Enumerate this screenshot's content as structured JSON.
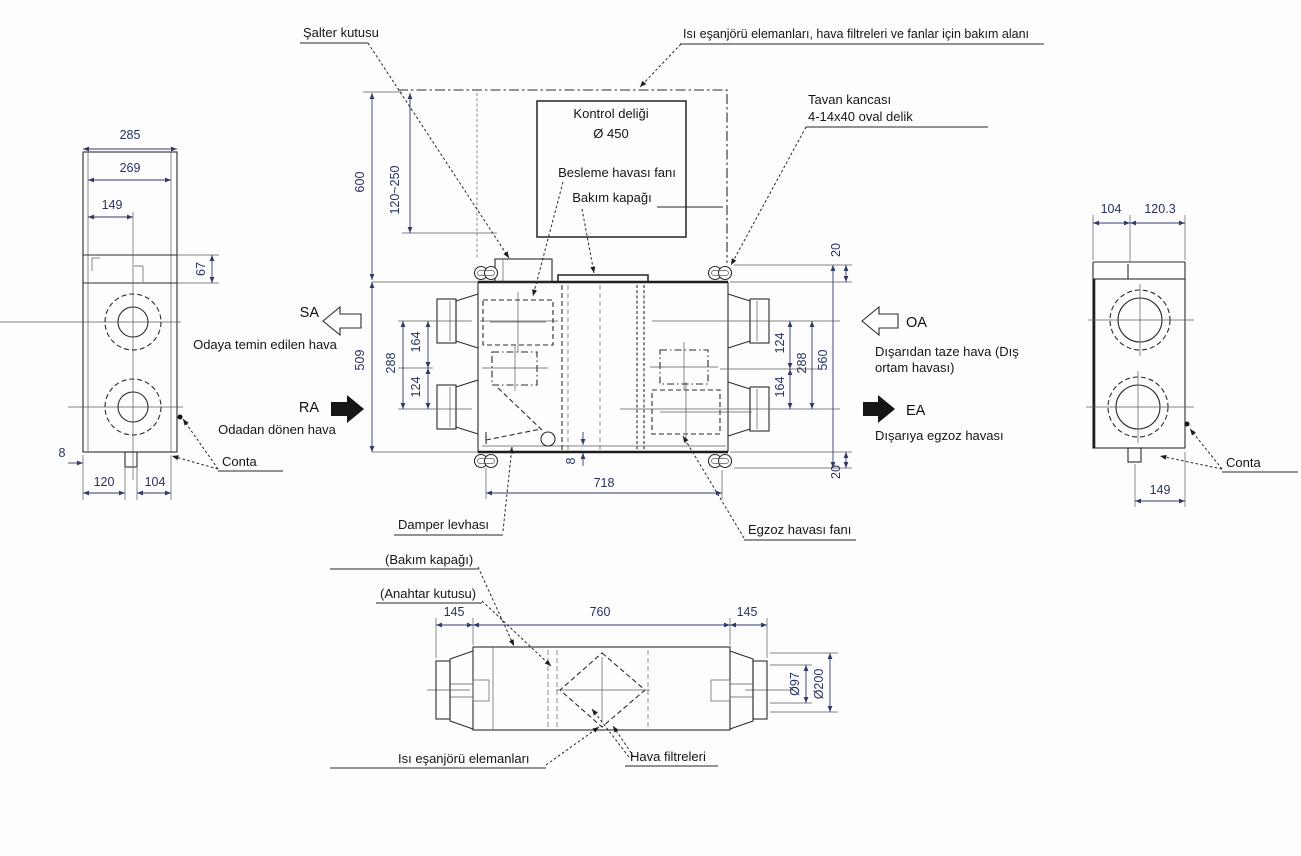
{
  "meta": {
    "drawing_type": "Isı geri kazanım cihazı boyut çizimi"
  },
  "top_labels": {
    "salter_kutusu": "Şalter kutusu",
    "bakim_alani": "Isı eşanjörü elemanları, hava filtreleri ve fanlar için bakım alanı",
    "kontrol_deligi": "Kontrol deliği",
    "kontrol_deligi_cap": "Ø 450",
    "besleme_fani": "Besleme havası fanı",
    "bakim_kapagi": "Bakım kapağı",
    "tavan_kancasi": "Tavan kancası",
    "tavan_kancasi_detay": "4-14x40 oval delik"
  },
  "plan_labels": {
    "damper_levhasi": "Damper levhası",
    "egzoz_fani": "Egzoz havası fanı"
  },
  "airflow": {
    "sa_code": "SA",
    "sa_desc": "Odaya temin edilen hava",
    "ra_code": "RA",
    "ra_desc": "Odadan dönen hava",
    "oa_code": "OA",
    "oa_desc1": "Dışarıdan taze hava (Dış",
    "oa_desc2": "ortam havası)",
    "ea_code": "EA",
    "ea_desc": "Dışarıya egzoz havası"
  },
  "left_view": {
    "dim_285": "285",
    "dim_269": "269",
    "dim_149": "149",
    "dim_67": "67",
    "dim_8": "8",
    "dim_120": "120",
    "dim_104": "104",
    "conta": "Conta"
  },
  "plan_view": {
    "dim_600": "600",
    "dim_120_250": "120~250",
    "dim_509": "509",
    "dim_288_left": "288",
    "dim_164_left": "164",
    "dim_124_left": "124",
    "dim_20_top": "20",
    "dim_124_right": "124",
    "dim_288_right": "288",
    "dim_164_right": "164",
    "dim_560": "560",
    "dim_20_bottom": "20",
    "dim_8": "8",
    "dim_718": "718"
  },
  "right_view": {
    "dim_104": "104",
    "dim_120_3": "120.3",
    "dim_149": "149",
    "conta": "Conta"
  },
  "bottom_view": {
    "label_bakim_kapagi": "(Bakım kapağı)",
    "label_anahtar_kutusu": "(Anahtar kutusu)",
    "dim_145_left": "145",
    "dim_760": "760",
    "dim_145_right": "145",
    "dim_d97": "Ø97",
    "dim_d200": "Ø200",
    "label_isi_esanjoru": "Isı eşanjörü elemanları",
    "label_hava_filtreleri": "Hava filtreleri"
  }
}
